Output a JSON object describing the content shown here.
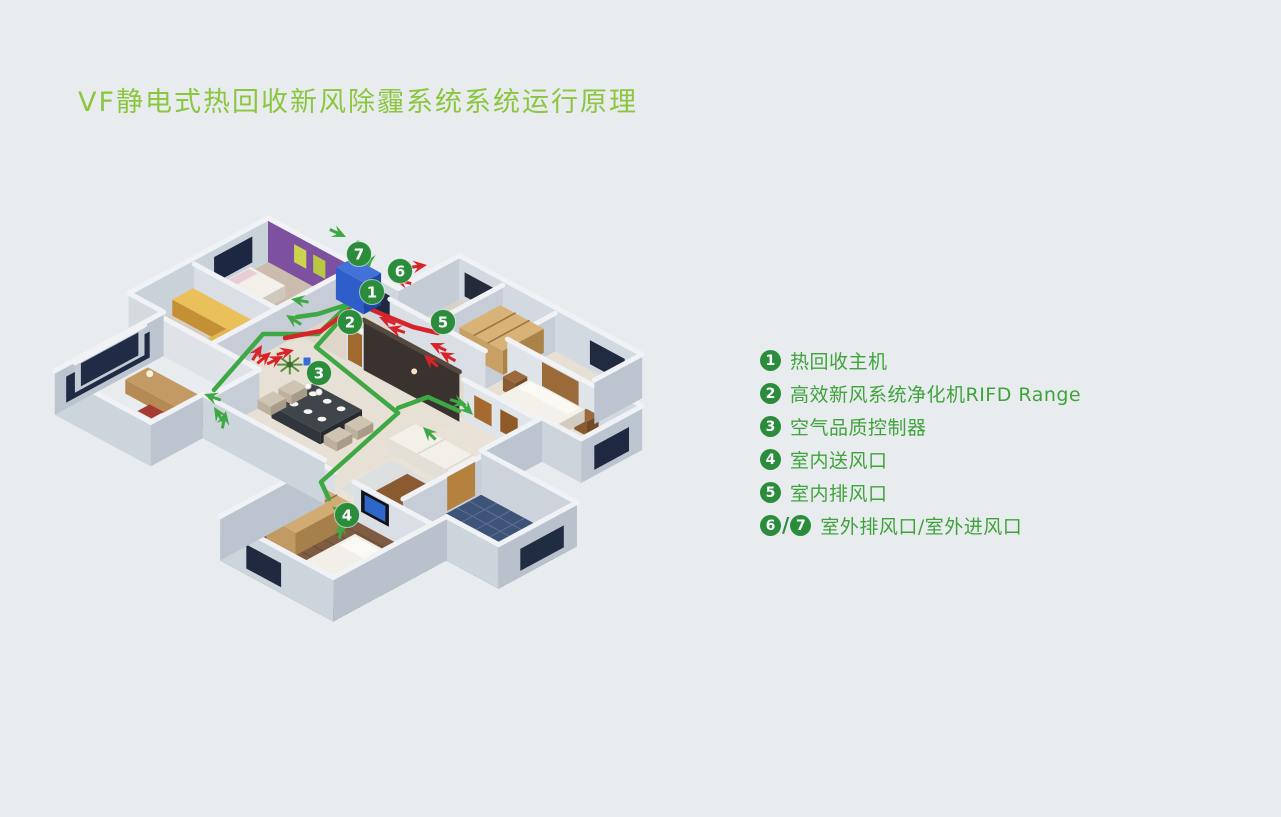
{
  "title": "VF静电式热回收新风除霾系统系统运行原理",
  "colors": {
    "background": "#E9ECEF",
    "title_green": "#8CC63F",
    "legend_text_green": "#3FA33C",
    "badge_green": "#2B8C3C",
    "duct_green": "#3EA844",
    "duct_red": "#D8232A",
    "unit_blue": "#2D5EC9",
    "bathroom_blue": "#3D5478"
  },
  "legend": {
    "items": [
      {
        "nums": [
          "1"
        ],
        "label": "热回收主机"
      },
      {
        "nums": [
          "2"
        ],
        "label": "高效新风系统净化机RIFD Range"
      },
      {
        "nums": [
          "3"
        ],
        "label": "空气品质控制器"
      },
      {
        "nums": [
          "4"
        ],
        "label": "室内送风口"
      },
      {
        "nums": [
          "5"
        ],
        "label": "室内排风口"
      },
      {
        "nums": [
          "6",
          "7"
        ],
        "label": "室外排风口/室外进风口"
      }
    ]
  },
  "floorplan": {
    "markers": [
      {
        "num": "1",
        "label": "热回收主机"
      },
      {
        "num": "2",
        "label": "高效新风系统净化机RIFD Range"
      },
      {
        "num": "3",
        "label": "空气品质控制器"
      },
      {
        "num": "4",
        "label": "室内送风口"
      },
      {
        "num": "5",
        "label": "室内排风口"
      },
      {
        "num": "6",
        "label": "室外排风口"
      },
      {
        "num": "7",
        "label": "室外进风口"
      }
    ]
  }
}
